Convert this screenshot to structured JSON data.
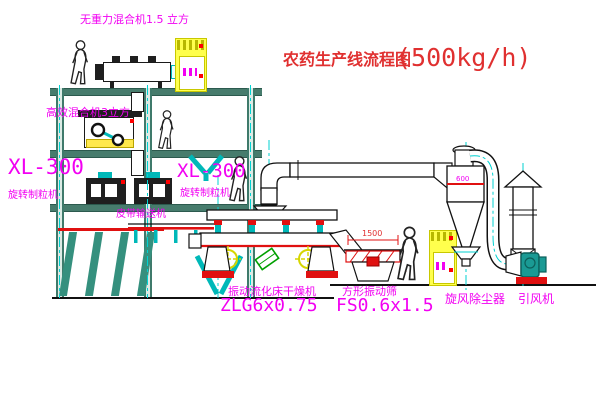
{
  "diagram": {
    "title": {
      "main": "农药生产线流程图",
      "capacity": "(500kg/h)"
    },
    "labels": {
      "top_mixer": "无重力混合机1.5 立方",
      "second_mixer": "高效混合机3立方",
      "granulator_left_model": "XL-300",
      "granulator_left_name": "旋转制粒机",
      "granulator_right_model": "XL-300",
      "granulator_right_name": "旋转制粒机",
      "belt_conveyor": "皮带输送机",
      "dryer_name": "振动流化床干燥机",
      "dryer_model": "ZLG6x0.75",
      "sieve_name": "方形振动筛",
      "sieve_model": "FS0.6x1.5",
      "cyclone_name": "旋风除尘器",
      "fan_name": "引风机"
    },
    "dimensions": {
      "sieve_width": "1500",
      "cyclone_marking": "600"
    },
    "colors": {
      "label_magenta": "#f200f2",
      "title_red": "#e03030",
      "structure_green": "#477c6d",
      "centerline_cyan": "#00d2d2",
      "pipe_teal": "#00b8b8",
      "equipment_yellow": "#ffff4d",
      "accent_red": "#e01010",
      "fan_teal": "#1a9a94"
    }
  }
}
